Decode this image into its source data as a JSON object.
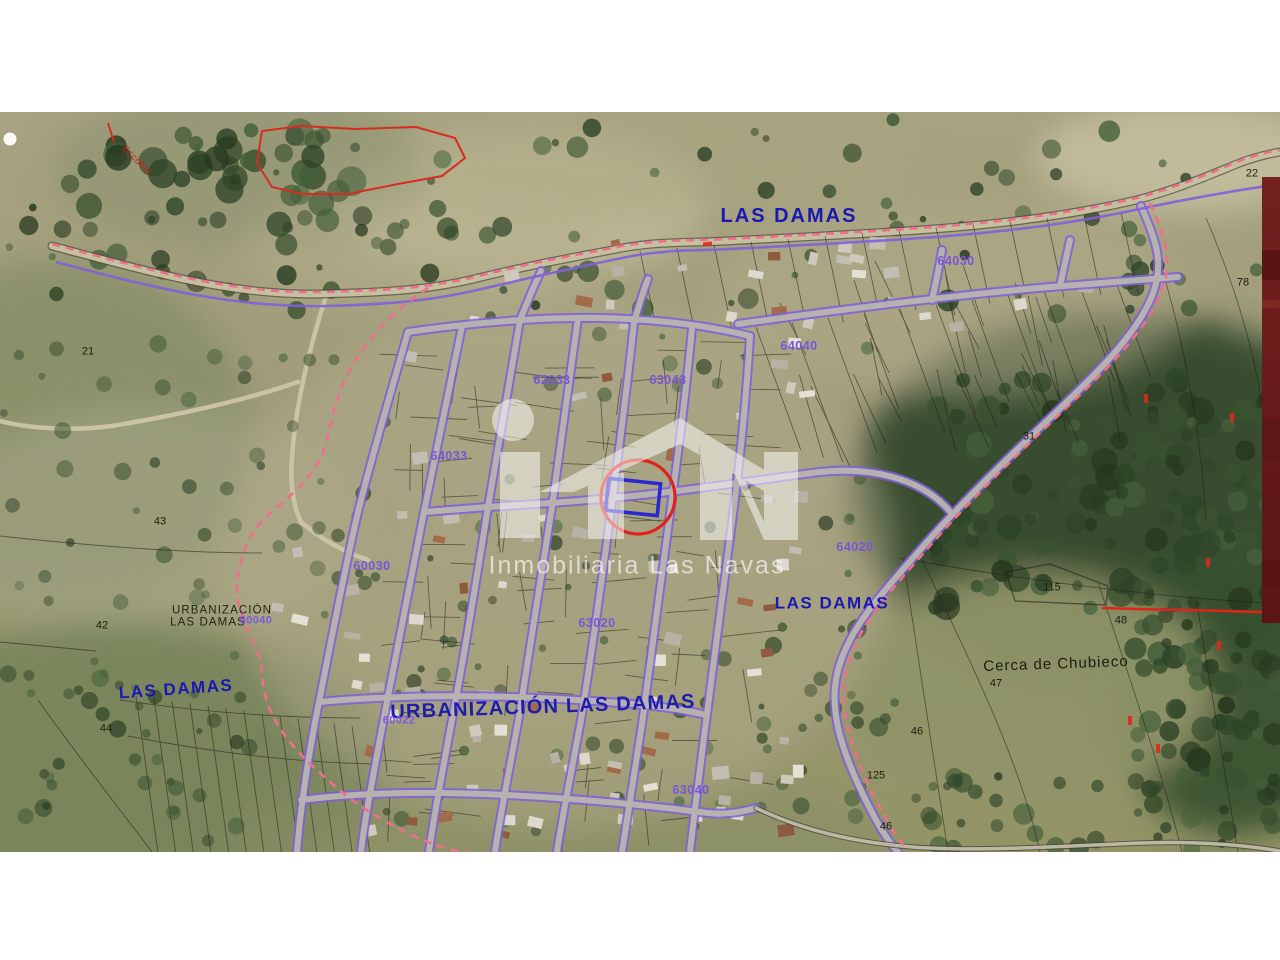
{
  "map": {
    "watermark": {
      "text": "Inmobiliaria Las Navas",
      "logo": "house-iln-logo"
    },
    "highlight": {
      "circle_color": "#e0221e",
      "parcel_outline_color": "#2a28cf"
    },
    "colors": {
      "area_label_blue": "#1a18b2",
      "parcel_label_purple": "#7a55d8",
      "boundary_violet": "#8160da",
      "boundary_dashed_pink": "#ef6e8e",
      "road_gray": "#b7b5ae",
      "terrain_olive": "#9d9a77",
      "margin_bar_maroon": "#6d1d1c"
    },
    "labels": [
      {
        "name": "label-las-damas-north",
        "text": "LAS DAMAS",
        "x": 789,
        "y": 216,
        "style": "blueXL",
        "rot": 0
      },
      {
        "name": "label-parcel-64030",
        "text": "64030",
        "x": 956,
        "y": 261,
        "style": "purple",
        "rot": 0
      },
      {
        "name": "label-parcel-64040",
        "text": "64040",
        "x": 799,
        "y": 346,
        "style": "purple",
        "rot": 0
      },
      {
        "name": "label-parcel-62033",
        "text": "62033",
        "x": 552,
        "y": 380,
        "style": "purple",
        "rot": 0
      },
      {
        "name": "label-parcel-63043",
        "text": "63043",
        "x": 668,
        "y": 380,
        "style": "purple",
        "rot": 0
      },
      {
        "name": "label-parcel-64033",
        "text": "64033",
        "x": 449,
        "y": 456,
        "style": "purple",
        "rot": 0
      },
      {
        "name": "label-parcel-60030",
        "text": "60030",
        "x": 372,
        "y": 566,
        "style": "purple",
        "rot": 0
      },
      {
        "name": "label-parcel-64020",
        "text": "64020",
        "x": 855,
        "y": 547,
        "style": "purple",
        "rot": 0
      },
      {
        "name": "label-las-damas-east",
        "text": "LAS DAMAS",
        "x": 832,
        "y": 603,
        "style": "blueL",
        "rot": 0
      },
      {
        "name": "label-urbanizacion-line1",
        "text": "URBANIZACIÓN",
        "x": 222,
        "y": 611,
        "style": "blackSm",
        "rot": 0
      },
      {
        "name": "label-urbanizacion-line2",
        "text": "LAS DAMAS",
        "x": 208,
        "y": 623,
        "style": "blackSm",
        "rot": 0
      },
      {
        "name": "label-parcel-60040",
        "text": "60040",
        "x": 256,
        "y": 621,
        "style": "purpleSm",
        "rot": 0
      },
      {
        "name": "label-parcel-63020",
        "text": "63020",
        "x": 597,
        "y": 623,
        "style": "purple",
        "rot": 0
      },
      {
        "name": "label-cerca-de-chubieco",
        "text": "Cerca de Chubieco",
        "x": 1056,
        "y": 664,
        "style": "blackMd",
        "rot": -2
      },
      {
        "name": "label-las-damas-west",
        "text": "LAS DAMAS",
        "x": 176,
        "y": 689,
        "style": "blueL",
        "rot": -4
      },
      {
        "name": "label-urbanizacion-las-damas-main",
        "text": "URBANIZACIÓN LAS DAMAS",
        "x": 543,
        "y": 707,
        "style": "blueXL2",
        "rot": -2
      },
      {
        "name": "label-parcel-60022",
        "text": "60022",
        "x": 399,
        "y": 721,
        "style": "purpleSm",
        "rot": 0
      },
      {
        "name": "label-parcel-63040",
        "text": "63040",
        "x": 691,
        "y": 790,
        "style": "purple",
        "rot": 0
      },
      {
        "name": "label-road-escobar",
        "text": "Escobar",
        "x": 137,
        "y": 161,
        "style": "redSm",
        "rot": 44
      },
      {
        "name": "label-terrain-21",
        "text": "21",
        "x": 88,
        "y": 352,
        "style": "blackNum",
        "rot": 0
      },
      {
        "name": "label-terrain-43",
        "text": "43",
        "x": 160,
        "y": 522,
        "style": "blackNum",
        "rot": 0
      },
      {
        "name": "label-terrain-42",
        "text": "42",
        "x": 102,
        "y": 626,
        "style": "blackNum",
        "rot": 0
      },
      {
        "name": "label-terrain-44",
        "text": "44",
        "x": 106,
        "y": 729,
        "style": "blackNum",
        "rot": 0
      },
      {
        "name": "label-terrain-31",
        "text": "31",
        "x": 1029,
        "y": 437,
        "style": "blackNum",
        "rot": 0
      },
      {
        "name": "label-terrain-115",
        "text": "115",
        "x": 1052,
        "y": 588,
        "style": "blackNum",
        "rot": 0
      },
      {
        "name": "label-terrain-48",
        "text": "48",
        "x": 1121,
        "y": 621,
        "style": "blackNum",
        "rot": 0
      },
      {
        "name": "label-terrain-47",
        "text": "47",
        "x": 996,
        "y": 684,
        "style": "blackNum",
        "rot": 0
      },
      {
        "name": "label-terrain-46",
        "text": "46",
        "x": 917,
        "y": 732,
        "style": "blackNum",
        "rot": 0
      },
      {
        "name": "label-terrain-22",
        "text": "22",
        "x": 1252,
        "y": 174,
        "style": "blackNum",
        "rot": 0
      },
      {
        "name": "label-terrain-78",
        "text": "78",
        "x": 1243,
        "y": 283,
        "style": "blackNum",
        "rot": 0
      },
      {
        "name": "label-terrain-125",
        "text": "125",
        "x": 876,
        "y": 776,
        "style": "blackNum",
        "rot": 0
      },
      {
        "name": "label-terrain-46b",
        "text": "46",
        "x": 886,
        "y": 827,
        "style": "blackNum",
        "rot": 0
      }
    ]
  }
}
